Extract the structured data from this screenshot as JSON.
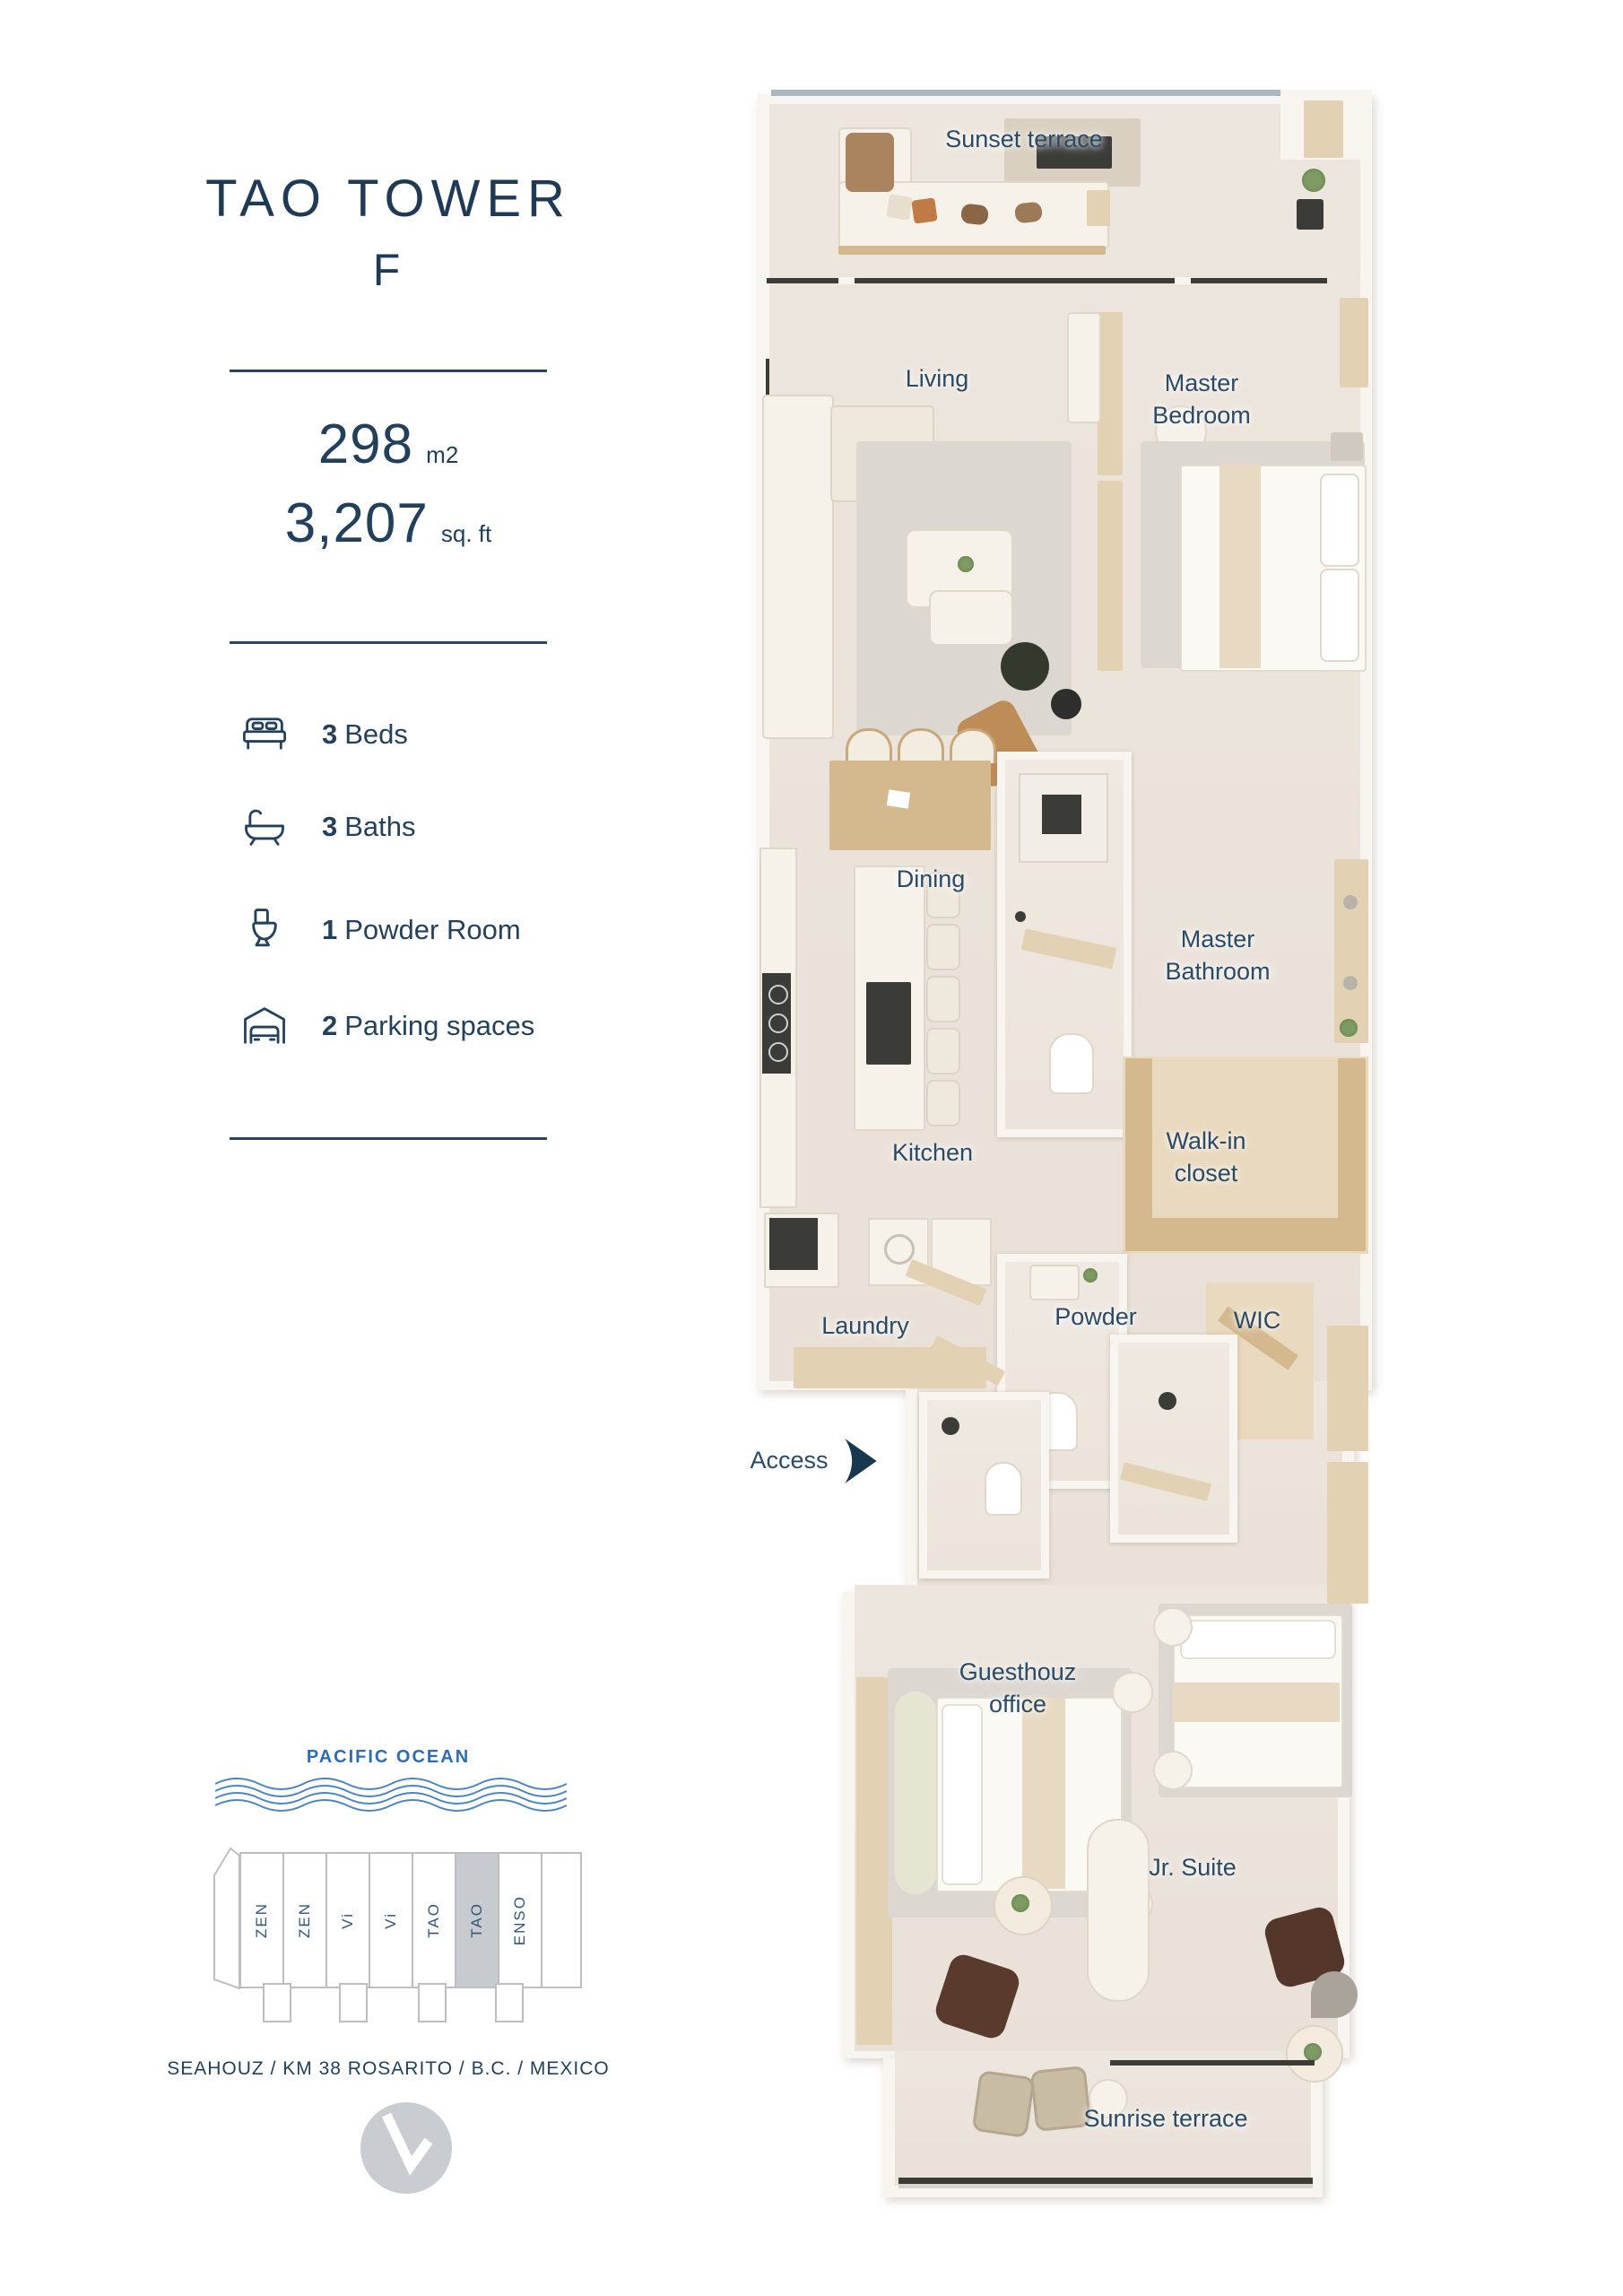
{
  "panel": {
    "title": "TAO TOWER",
    "unit": "F",
    "area_metric": {
      "value": "298",
      "unit": "m2"
    },
    "area_imperial": {
      "value": "3,207",
      "unit": "sq. ft"
    },
    "features": [
      {
        "icon": "bed-icon",
        "count": "3",
        "label": "Beds"
      },
      {
        "icon": "bathtub-icon",
        "count": "3",
        "label": "Baths"
      },
      {
        "icon": "toilet-icon",
        "count": "1",
        "label": "Powder Room"
      },
      {
        "icon": "garage-icon",
        "count": "2",
        "label": "Parking spaces"
      }
    ]
  },
  "floor_plan": {
    "labels": {
      "sunset_terrace": "Sunset terrace",
      "living": "Living",
      "master_bedroom": "Master Bedroom",
      "dining": "Dining",
      "master_bathroom": "Master Bathroom",
      "kitchen": "Kitchen",
      "walk_in_closet": "Walk-in closet",
      "laundry": "Laundry",
      "powder": "Powder",
      "wic": "WIC",
      "access": "Access",
      "guesthouz_office": "Guesthouz office",
      "jr_suite": "Jr. Suite",
      "sunrise_terrace": "Sunrise terrace"
    }
  },
  "site_map": {
    "ocean_label": "PACIFIC OCEAN",
    "towers": [
      "ZEN",
      "ZEN",
      "Vi",
      "Vi",
      "TAO",
      "TAO",
      "ENSO"
    ],
    "highlighted_tower_index": 5,
    "address": "SEAHOUZ / KM 38 ROSARITO / B.C. / MEXICO"
  },
  "colors": {
    "navy": "#24415C",
    "ocean_blue": "#2F6CB0",
    "tower_highlight": "#C7CACE",
    "floor_beige": "#ECE5DD"
  }
}
